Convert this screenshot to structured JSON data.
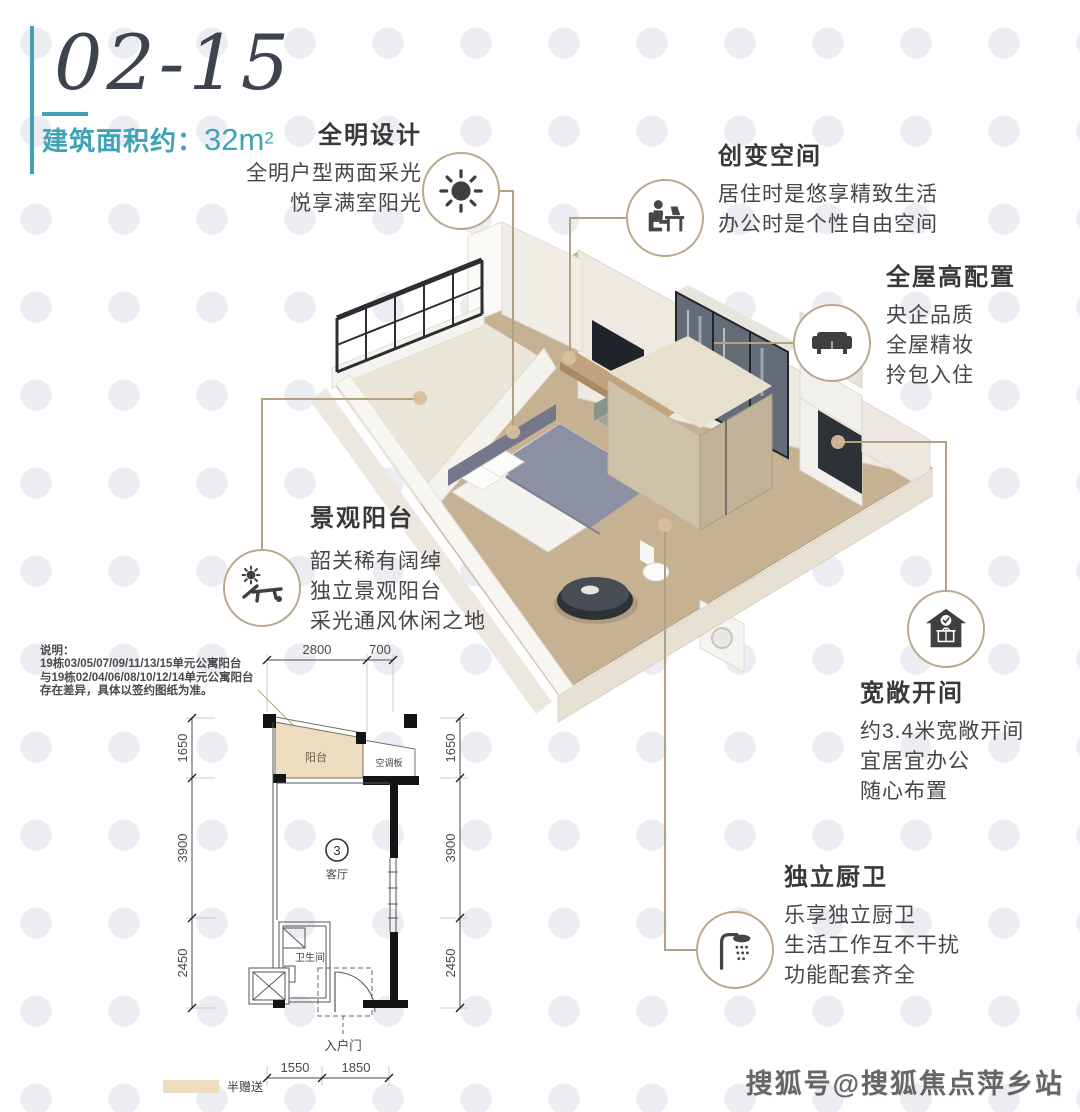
{
  "header": {
    "unit_code": "02-15",
    "area_label": "建筑面积约：",
    "area_value": "32m",
    "area_sup": "2",
    "accent_color": "#3fa2b5"
  },
  "features": [
    {
      "title": "全明设计",
      "icon": "sun-icon",
      "lines": [
        "全明户型两面采光",
        "悦享满室阳光"
      ]
    },
    {
      "title": "创变空间",
      "icon": "person-at-desk-icon",
      "lines": [
        "居住时是悠享精致生活",
        "办公时是个性自由空间"
      ]
    },
    {
      "title": "全屋高配置",
      "icon": "sofa-icon",
      "lines": [
        "央企品质",
        "全屋精妆",
        "拎包入住"
      ]
    },
    {
      "title": "景观阳台",
      "icon": "sun-lounger-icon",
      "lines": [
        "韶关稀有阔绰",
        "独立景观阳台",
        "采光通风休闲之地"
      ]
    },
    {
      "title": "宽敞开间",
      "icon": "house-check-icon",
      "lines": [
        "约3.4米宽敞开间",
        "宜居宜办公",
        "随心布置"
      ]
    },
    {
      "title": "独立厨卫",
      "icon": "shower-icon",
      "lines": [
        "乐享独立厨卫",
        "生活工作互不干扰",
        "功能配套齐全"
      ]
    }
  ],
  "note": {
    "title": "说明：",
    "lines": [
      "19栋03/05/07/09/11/13/15单元公寓阳台",
      "与19栋02/04/06/08/10/12/14单元公寓阳台",
      "存在差异，具体以签约图纸为准。"
    ]
  },
  "floorplan": {
    "dims_top": [
      "2800",
      "700"
    ],
    "dims_left": [
      "1650",
      "3900",
      "2450"
    ],
    "dims_right": [
      "1650",
      "3900",
      "2450"
    ],
    "dims_bottom": [
      "1550",
      "1850"
    ],
    "labels": {
      "balcony": "阳台",
      "ac_board": "空调板",
      "living_room": "客厅",
      "unit_number": "3",
      "bathroom": "卫生间",
      "entry_door": "入户门",
      "legend_half_gift": "半赠送"
    }
  },
  "watermark": "搜狐号@搜狐焦点萍乡站",
  "colors": {
    "accent_teal": "#3fa2b5",
    "connector_tan": "#b3a184",
    "balcony_fill": "#eddcbe",
    "icon_dark": "#3f3f3f"
  }
}
